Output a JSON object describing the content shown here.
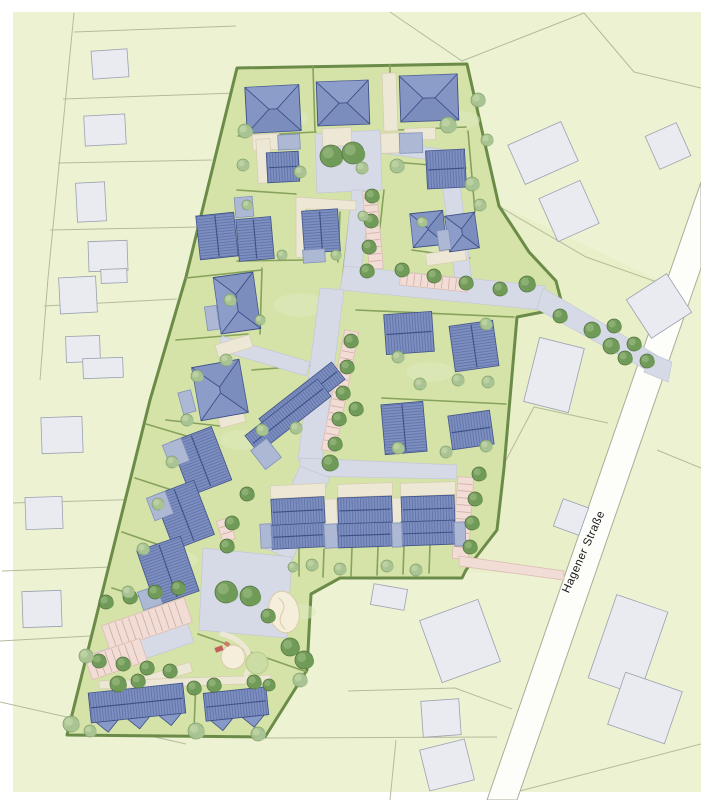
{
  "street_label": {
    "text": "Hagener Straße",
    "x": 584,
    "y": 552,
    "rotation_deg": -66,
    "font_size_px": 11.5
  },
  "palette": {
    "map_bg": "#edf2d3",
    "patch": "#e8efc9",
    "parcel_line": "#b4bb9b",
    "street": "#fdfdfa",
    "street_edge": "#a9ae97",
    "building": "#e9ebf1",
    "building_edge": "#9aa1b0",
    "site": "#d5e3a8",
    "hedge": "#6b8b48",
    "hedge_light": "#87a25c",
    "road": "#d6dae7",
    "road_edge": "#c3c8d6",
    "beige": "#ede7d5",
    "beige_edge": "#d6cbb0",
    "pink": "#f2dcd6",
    "pink_line": "#cfaca2",
    "pink_edge": "#dcbcb2",
    "roof": "#7d8fc0",
    "roof_stripe": "#54669c",
    "ridge": "#3d5086",
    "hip": "#8495c4",
    "hip_light": "#93a4ce",
    "hip_dark": "#7183b5",
    "apt_gable": "#8799c6",
    "garage": "#adb8d4",
    "garage_edge": "#8291b8",
    "tree_dark": "#6f9a57",
    "tree_dark_edge": "#4e7038",
    "tree_dark_hi": "#9fbd85",
    "tree_light": "#a9c392",
    "tree_light_edge": "#7fa06a",
    "tree_light_hi": "#c9daae",
    "lawn": "#dfe9bb",
    "sand": "#f4eedb",
    "sand_line": "#d9cba6",
    "mound": "#cbdda4",
    "mound_edge": "#b7cc8c",
    "play_red": "#c4605c",
    "play_red2": "#d0756a"
  },
  "background": {
    "margin": {
      "left": 13,
      "top": 12,
      "width": 688,
      "height": 780
    },
    "patches": [
      {
        "d": "M500,205 L665,283 L565,575 L462,572 L505,460 L515,316 Z"
      }
    ]
  },
  "parcel_lines": [
    "M74,13 L48,278",
    "M48,278 L40,380",
    "M74,32 L236,26",
    "M63,99 L237,93",
    "M58,163 L212,160",
    "M50,230 L199,227",
    "M44,306 L177,299",
    "M13,503 L148,499",
    "M2,571 L112,567",
    "M0,641 L90,636",
    "M0,702 L186,744",
    "M265,738 L497,737",
    "M348,691 L455,688 L512,709",
    "M396,740 L390,800",
    "M512,793 L701,744",
    "M390,12 L462,61",
    "M462,61 L584,13",
    "M584,13 L634,72",
    "M634,72 L701,88",
    "M500,207 L586,257 L657,282",
    "M608,423 L534,407 L505,462",
    "M657,450 L701,468"
  ],
  "street": {
    "d": "M487,800 L701,182 L701,268 L517,800 Z"
  },
  "existing_buildings": [
    [
      110,
      64,
      36,
      28,
      -4
    ],
    [
      105,
      130,
      41,
      30,
      -3
    ],
    [
      91,
      202,
      29,
      39,
      -3
    ],
    [
      108,
      256,
      39,
      30,
      -2
    ],
    [
      114,
      276,
      26,
      14,
      -2
    ],
    [
      78,
      295,
      37,
      36,
      -3
    ],
    [
      83,
      349,
      34,
      26,
      -2
    ],
    [
      103,
      368,
      40,
      20,
      -2
    ],
    [
      62,
      435,
      41,
      36,
      -2
    ],
    [
      44,
      513,
      37,
      32,
      -2
    ],
    [
      42,
      609,
      39,
      36,
      -2
    ],
    [
      389,
      597,
      34,
      21,
      10
    ],
    [
      460,
      641,
      62,
      66,
      -20
    ],
    [
      441,
      718,
      38,
      36,
      -4
    ],
    [
      447,
      765,
      46,
      42,
      -14
    ],
    [
      543,
      153,
      58,
      43,
      -24
    ],
    [
      569,
      211,
      45,
      47,
      -24
    ],
    [
      668,
      146,
      34,
      36,
      -24
    ],
    [
      659,
      306,
      48,
      46,
      -33
    ],
    [
      554,
      375,
      46,
      66,
      14
    ],
    [
      571,
      517,
      27,
      29,
      20
    ],
    [
      628,
      645,
      54,
      88,
      19
    ],
    [
      645,
      708,
      60,
      55,
      19
    ]
  ],
  "site": {
    "outline": "M237,68 L467,64 L499,206 L529,252 L556,281 L563,308 L517,317 L509,410 L504,468 L497,530 L466,570 L462,578 L340,578 L311,594 L307,670 L265,737 L67,735 L150,400 L186,277 Z"
  },
  "lawn_patches": [
    [
      280,
      118,
      28,
      12
    ],
    [
      225,
      245,
      22,
      10
    ],
    [
      300,
      305,
      26,
      12
    ],
    [
      240,
      440,
      20,
      10
    ],
    [
      430,
      372,
      24,
      10
    ],
    [
      300,
      612,
      16,
      8
    ],
    [
      140,
      706,
      26,
      10
    ],
    [
      440,
      254,
      18,
      8
    ],
    [
      460,
      120,
      20,
      9
    ],
    [
      180,
      560,
      18,
      9
    ]
  ],
  "inner_hedges": [
    "M313,67 L315,131",
    "M390,65 L390,128",
    "M238,136 L316,132",
    "M398,130 L466,127",
    "M237,190 L296,194",
    "M306,210 L306,258",
    "M237,261 L306,260",
    "M340,212 L338,262",
    "M394,162 L466,168",
    "M412,250 L470,258",
    "M468,131 L475,212",
    "M186,278 L262,270",
    "M262,268 L260,334",
    "M176,340 L248,334",
    "M252,370 L330,364",
    "M166,420 L220,426",
    "M356,310 L514,317",
    "M382,398 L506,404",
    "M299,548 L299,576",
    "M324,549 L323,577",
    "M352,548 L351,576",
    "M378,547 L377,575",
    "M404,546 L403,574",
    "M430,545 L429,573",
    "M146,424 L200,440",
    "M135,478 L184,494",
    "M122,532 L168,548",
    "M112,588 L150,600",
    "M198,634 L307,672",
    "M196,680 L194,728",
    "M384,190 L374,282",
    "M352,196 L342,282"
  ],
  "roads_paths": [
    "M315,134 L380,130 L382,190 L317,193 Z",
    "M382,141 L448,150 L446,162 L381,153 Z",
    "M438,155 L456,152 L472,282 L456,285 Z",
    "M352,190 L370,190 L360,285 L342,283 Z",
    "M344,266 L545,286 L541,310 L340,290 Z",
    "M543,288 L658,356 L650,372 L537,309 Z",
    "M320,288 L344,290 L322,462 L298,460 Z",
    "M300,458 L457,465 L456,479 L300,476 Z",
    "M300,466 L330,478 L292,560 L264,548 Z",
    "M203,548 L292,557 L287,638 L199,630 Z",
    "M222,336 L310,362 L306,376 L218,350 Z",
    "M648,352 L672,362 L668,382 L644,372 Z"
  ],
  "roads_rects": [
    [
      143,
      648,
      100,
      22,
      -19
    ]
  ],
  "beige_rects": [
    [
      266,
      142,
      27,
      16,
      -3
    ],
    [
      337,
      137,
      29,
      18,
      -2
    ],
    [
      390,
      102,
      14,
      58,
      -2
    ],
    [
      420,
      134,
      31,
      12,
      -2
    ],
    [
      391,
      143,
      20,
      20,
      -2
    ],
    [
      264,
      161,
      14,
      44,
      -3
    ],
    [
      446,
      257,
      40,
      12,
      -8
    ],
    [
      234,
      346,
      36,
      13,
      -17
    ],
    [
      232,
      420,
      26,
      10,
      -15
    ],
    [
      330,
      374,
      20,
      12,
      -38
    ],
    [
      298,
      491,
      55,
      13,
      -3
    ],
    [
      365,
      490,
      55,
      13,
      -2
    ],
    [
      428,
      489,
      55,
      13,
      -2
    ],
    [
      331,
      512,
      12,
      26,
      -2
    ],
    [
      397,
      511,
      12,
      26,
      -2
    ],
    [
      216,
      470,
      12,
      30,
      -21
    ],
    [
      199,
      524,
      12,
      30,
      -21
    ],
    [
      184,
      580,
      12,
      30,
      -19
    ],
    [
      152,
      679,
      82,
      10,
      -17
    ],
    [
      185,
      682,
      172,
      8,
      -2
    ]
  ],
  "beige_paths": [
    "M296,197 L356,201 L356,210 L306,209 L306,258 L296,257 Z"
  ],
  "parking_strips": [
    [
      373,
      230,
      14,
      78,
      -5
    ],
    [
      340,
      391,
      14,
      122,
      11
    ],
    [
      463,
      518,
      16,
      82,
      4
    ],
    [
      147,
      624,
      87,
      26,
      -19
    ],
    [
      116,
      659,
      58,
      24,
      -19
    ],
    [
      434,
      282,
      68,
      13,
      6
    ],
    [
      226,
      530,
      13,
      22,
      -18
    ]
  ],
  "pink_paths": [
    "M459,556 L564,571 L564,580 L459,566 Z"
  ],
  "houses": [
    [
      273,
      109,
      54,
      46,
      -3,
      "hip"
    ],
    [
      343,
      103,
      52,
      44,
      -2,
      "hip"
    ],
    [
      429,
      98,
      58,
      46,
      -2,
      "hip"
    ],
    [
      237,
      303,
      40,
      57,
      -8,
      "hip"
    ],
    [
      220,
      390,
      48,
      54,
      -10,
      "hip"
    ],
    [
      428,
      229,
      33,
      34,
      -6,
      "hip"
    ],
    [
      462,
      232,
      30,
      36,
      -8,
      "hip"
    ],
    [
      283,
      167,
      32,
      30,
      -3,
      "gable"
    ],
    [
      321,
      231,
      36,
      42,
      -4,
      "gable"
    ],
    [
      217,
      236,
      38,
      44,
      -6,
      "gable"
    ],
    [
      255,
      239,
      35,
      42,
      -5,
      "gable"
    ],
    [
      446,
      169,
      39,
      38,
      -3,
      "gable"
    ],
    [
      409,
      333,
      48,
      40,
      -4,
      "gable"
    ],
    [
      474,
      346,
      44,
      46,
      -8,
      "gable"
    ],
    [
      404,
      428,
      42,
      50,
      -5,
      "gable"
    ],
    [
      471,
      430,
      42,
      34,
      -8,
      "gable"
    ],
    [
      302,
      399,
      92,
      22,
      -38,
      "gable"
    ],
    [
      288,
      416,
      92,
      22,
      -38,
      "gable"
    ],
    [
      298,
      511,
      53,
      26,
      -3,
      "gable"
    ],
    [
      298,
      536,
      53,
      24,
      -3,
      "gable"
    ],
    [
      365,
      510,
      54,
      26,
      -2,
      "gable"
    ],
    [
      365,
      535,
      54,
      24,
      -2,
      "gable"
    ],
    [
      428,
      509,
      53,
      26,
      -2,
      "gable"
    ],
    [
      428,
      533,
      53,
      24,
      -2,
      "gable"
    ],
    [
      201,
      461,
      44,
      57,
      -21,
      "gable"
    ],
    [
      184,
      515,
      43,
      58,
      -21,
      "gable"
    ],
    [
      168,
      571,
      46,
      58,
      -19,
      "gable"
    ],
    [
      289,
      142,
      22,
      15,
      -3,
      "garage"
    ],
    [
      411,
      143,
      23,
      20,
      -2,
      "garage"
    ],
    [
      314,
      256,
      22,
      13,
      -4,
      "garage"
    ],
    [
      244,
      207,
      18,
      20,
      -5,
      "garage"
    ],
    [
      444,
      240,
      12,
      20,
      -8,
      "garage"
    ],
    [
      212,
      318,
      12,
      24,
      -8,
      "garage"
    ],
    [
      187,
      402,
      13,
      22,
      -15,
      "garage"
    ],
    [
      266,
      454,
      20,
      24,
      -38,
      "garage"
    ],
    [
      176,
      453,
      20,
      24,
      -21,
      "garage"
    ],
    [
      160,
      506,
      20,
      24,
      -21,
      "garage"
    ],
    [
      150,
      598,
      20,
      19,
      -19,
      "garage"
    ],
    [
      266,
      536,
      11,
      24,
      -3,
      "garage"
    ],
    [
      331,
      536,
      13,
      24,
      -3,
      "garage"
    ],
    [
      397,
      535,
      10,
      24,
      -2,
      "garage"
    ],
    [
      460,
      534,
      11,
      24,
      -2,
      "garage"
    ],
    [
      137,
      703,
      95,
      30,
      -6,
      "apt",
      3
    ],
    [
      236,
      704,
      63,
      28,
      -6,
      "apt",
      2
    ]
  ],
  "playground": [
    {
      "type": "path",
      "d": "M222,634 q18,4 26,18 q6,12 -2,22",
      "stroke": "beige",
      "width": 5
    },
    {
      "type": "ellipse",
      "cx": 284,
      "cy": 612,
      "rx": 15,
      "ry": 21,
      "rot": -12,
      "fill": "sand",
      "strokec": "sand_line"
    },
    {
      "type": "path",
      "d": "M279,598 q8,7 3,15 q-5,9 3,16",
      "stroke": "sand_line",
      "width": 1
    },
    {
      "type": "circle",
      "cx": 233,
      "cy": 657,
      "rad": 12,
      "fill": "sand",
      "strokec": "sand_line"
    },
    {
      "type": "circle",
      "cx": 257,
      "cy": 663,
      "rad": 11,
      "fill": "mound",
      "strokec": "mound_edge"
    },
    {
      "type": "rect",
      "cx": 219,
      "cy": 649,
      "w": 8,
      "h": 5,
      "rot": -20,
      "fill": "play_red"
    },
    {
      "type": "rect",
      "cx": 227,
      "cy": 644,
      "w": 5,
      "h": 4,
      "rot": 30,
      "fill": "play_red2"
    }
  ],
  "trees": [
    [
      331,
      156,
      11,
      0
    ],
    [
      353,
      153,
      11,
      0
    ],
    [
      372,
      196,
      7,
      0
    ],
    [
      371,
      221,
      7,
      0
    ],
    [
      369,
      247,
      7,
      0
    ],
    [
      367,
      271,
      7,
      0
    ],
    [
      402,
      270,
      7,
      0
    ],
    [
      434,
      276,
      7,
      0
    ],
    [
      466,
      283,
      7,
      0
    ],
    [
      500,
      289,
      7,
      0
    ],
    [
      527,
      284,
      8,
      0
    ],
    [
      560,
      316,
      7,
      0
    ],
    [
      592,
      330,
      8,
      0
    ],
    [
      614,
      326,
      7,
      0
    ],
    [
      611,
      346,
      8,
      0
    ],
    [
      634,
      344,
      7,
      0
    ],
    [
      647,
      361,
      7,
      0
    ],
    [
      625,
      358,
      7,
      0
    ],
    [
      351,
      341,
      7,
      0
    ],
    [
      347,
      367,
      7,
      0
    ],
    [
      343,
      393,
      7,
      0
    ],
    [
      339,
      419,
      7,
      0
    ],
    [
      335,
      444,
      7,
      0
    ],
    [
      356,
      409,
      7,
      0
    ],
    [
      330,
      463,
      8,
      0
    ],
    [
      479,
      474,
      7,
      0
    ],
    [
      475,
      499,
      7,
      0
    ],
    [
      472,
      523,
      7,
      0
    ],
    [
      470,
      547,
      7,
      0
    ],
    [
      232,
      523,
      7,
      0
    ],
    [
      227,
      546,
      7,
      0
    ],
    [
      247,
      494,
      7,
      0
    ],
    [
      226,
      592,
      11,
      0
    ],
    [
      250,
      596,
      10,
      0
    ],
    [
      268,
      616,
      7,
      0
    ],
    [
      290,
      647,
      9,
      0
    ],
    [
      304,
      660,
      9,
      0
    ],
    [
      106,
      602,
      7,
      0
    ],
    [
      130,
      597,
      7,
      0
    ],
    [
      155,
      592,
      7,
      0
    ],
    [
      178,
      588,
      7,
      0
    ],
    [
      99,
      661,
      7,
      0
    ],
    [
      123,
      664,
      7,
      0
    ],
    [
      147,
      668,
      7,
      0
    ],
    [
      170,
      671,
      7,
      0
    ],
    [
      118,
      684,
      8,
      0
    ],
    [
      138,
      681,
      7,
      0
    ],
    [
      194,
      688,
      7,
      0
    ],
    [
      214,
      685,
      7,
      0
    ],
    [
      254,
      682,
      7,
      0
    ],
    [
      269,
      685,
      6,
      0
    ],
    [
      86,
      656,
      7,
      1
    ],
    [
      71,
      724,
      8,
      1
    ],
    [
      90,
      731,
      6,
      1
    ],
    [
      196,
      731,
      8,
      1
    ],
    [
      258,
      734,
      7,
      1
    ],
    [
      300,
      680,
      7,
      1
    ],
    [
      187,
      420,
      6,
      1
    ],
    [
      172,
      462,
      6,
      1
    ],
    [
      158,
      504,
      6,
      1
    ],
    [
      143,
      549,
      6,
      1
    ],
    [
      128,
      592,
      6,
      1
    ],
    [
      197,
      376,
      6,
      1
    ],
    [
      245,
      131,
      7,
      1
    ],
    [
      243,
      165,
      6,
      1
    ],
    [
      300,
      172,
      6,
      1
    ],
    [
      362,
      168,
      6,
      1
    ],
    [
      397,
      166,
      7,
      1
    ],
    [
      448,
      125,
      8,
      1
    ],
    [
      478,
      100,
      7,
      1
    ],
    [
      487,
      140,
      6,
      1
    ],
    [
      472,
      184,
      7,
      1
    ],
    [
      480,
      205,
      6,
      1
    ],
    [
      247,
      205,
      5,
      1
    ],
    [
      282,
      255,
      5,
      1
    ],
    [
      336,
      255,
      5,
      1
    ],
    [
      363,
      216,
      5,
      1
    ],
    [
      422,
      222,
      5,
      1
    ],
    [
      230,
      300,
      6,
      1
    ],
    [
      260,
      320,
      5,
      1
    ],
    [
      226,
      360,
      6,
      1
    ],
    [
      296,
      428,
      6,
      1
    ],
    [
      262,
      430,
      6,
      1
    ],
    [
      398,
      357,
      6,
      1
    ],
    [
      458,
      380,
      6,
      1
    ],
    [
      420,
      384,
      6,
      1
    ],
    [
      488,
      382,
      6,
      1
    ],
    [
      486,
      324,
      6,
      1
    ],
    [
      398,
      448,
      6,
      1
    ],
    [
      446,
      452,
      6,
      1
    ],
    [
      486,
      446,
      6,
      1
    ],
    [
      312,
      565,
      6,
      1
    ],
    [
      340,
      569,
      6,
      1
    ],
    [
      387,
      566,
      6,
      1
    ],
    [
      416,
      570,
      6,
      1
    ],
    [
      293,
      567,
      5,
      1
    ]
  ]
}
